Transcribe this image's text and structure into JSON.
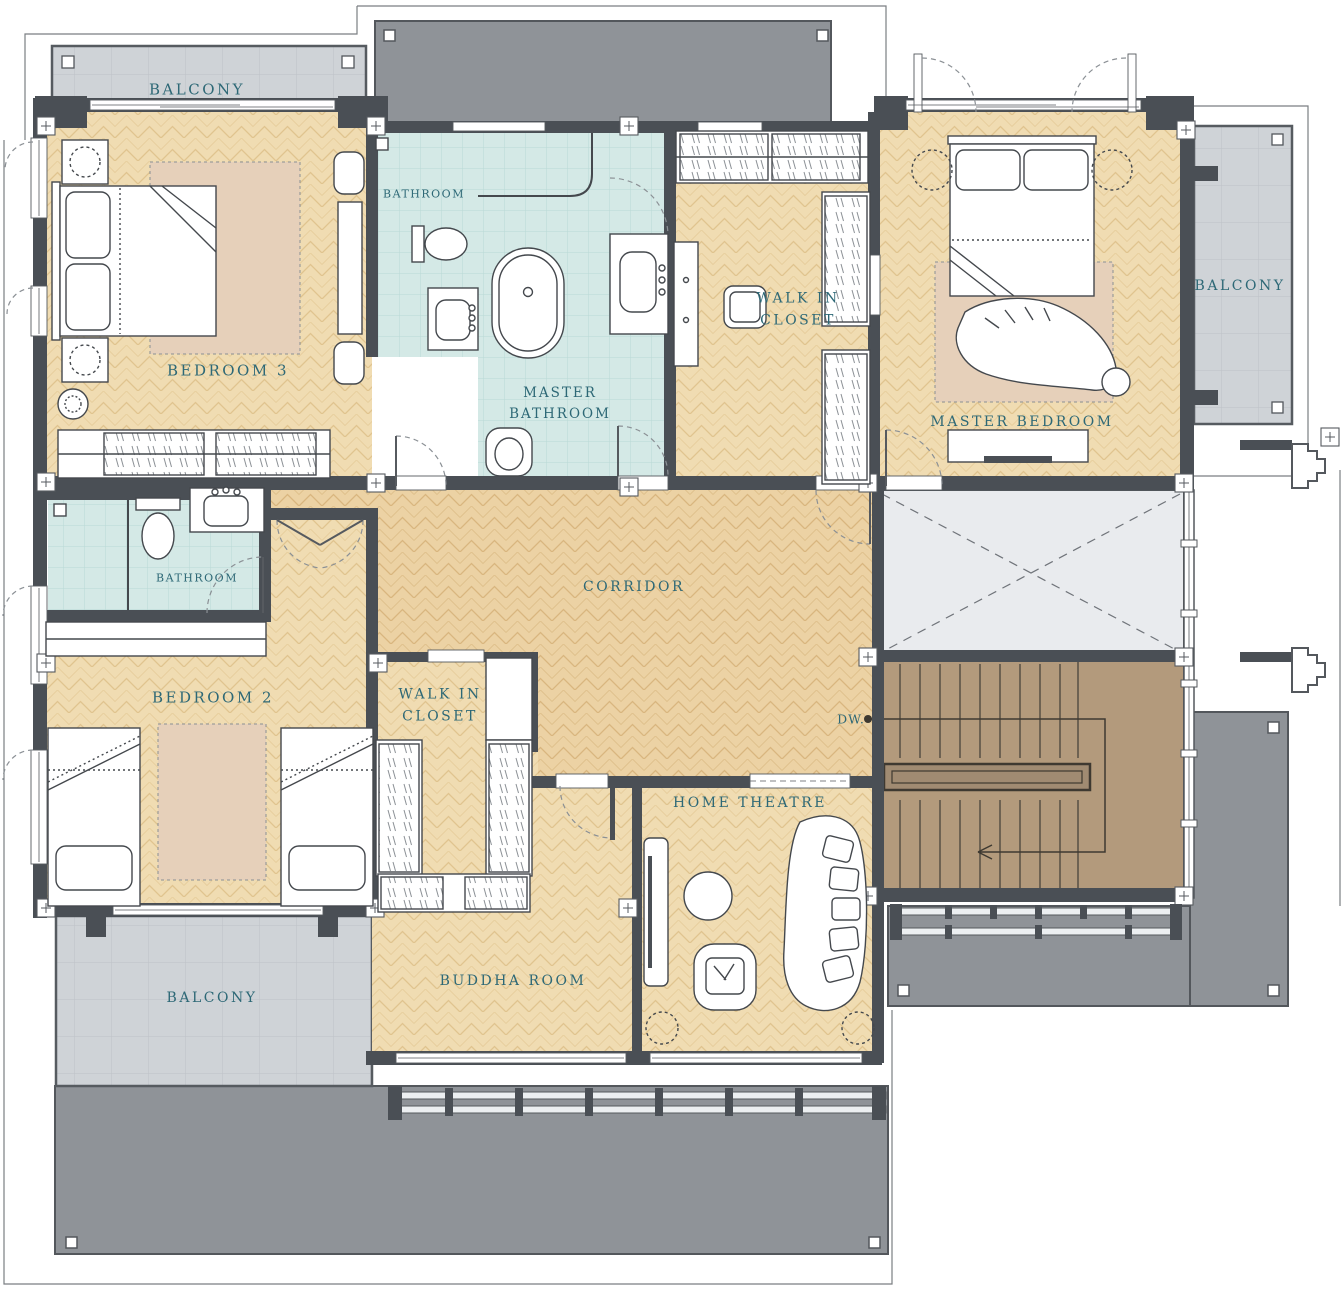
{
  "drawing": {
    "type": "architectural-floor-plan",
    "floor": "upper floor residential plan"
  },
  "rooms": [
    {
      "id": "balcony-top",
      "label": "BALCONY"
    },
    {
      "id": "bathroom-top",
      "label": "BATHROOM"
    },
    {
      "id": "bedroom-3",
      "label": "BEDROOM 3"
    },
    {
      "id": "master-bathroom",
      "lines": [
        "MASTER",
        "BATHROOM"
      ]
    },
    {
      "id": "walk-in-closet-1",
      "lines": [
        "WALK IN",
        "CLOSET"
      ]
    },
    {
      "id": "master-bedroom",
      "label": "MASTER BEDROOM"
    },
    {
      "id": "balcony-right",
      "label": "BALCONY"
    },
    {
      "id": "bathroom-2",
      "label": "BATHROOM"
    },
    {
      "id": "corridor",
      "label": "CORRIDOR"
    },
    {
      "id": "bedroom-2",
      "label": "BEDROOM 2"
    },
    {
      "id": "walk-in-closet-2",
      "lines": [
        "WALK IN",
        "CLOSET"
      ]
    },
    {
      "id": "dumbwaiter",
      "label": "DW."
    },
    {
      "id": "home-theatre",
      "label": "HOME THEATRE"
    },
    {
      "id": "buddha-room",
      "label": "BUDDHA ROOM"
    },
    {
      "id": "balcony-bottom",
      "label": "BALCONY"
    }
  ],
  "palette": {
    "label_text": "#2d6876",
    "wall": "#4a4f55",
    "wood_floor": "#f0dcb2",
    "corridor_floor": "#ecd2a4",
    "bathroom_tile": "#d4e9e6",
    "balcony_gray": "#cfd3d7",
    "roof_gray": "#8f9398",
    "stair_brown": "#b39a7c",
    "void_gray": "#e9ebee",
    "rug_beige": "#e6d0ba"
  }
}
